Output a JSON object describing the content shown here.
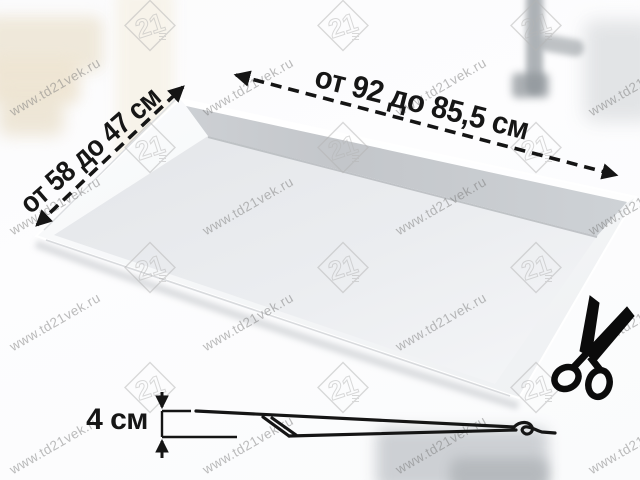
{
  "annotations": {
    "width_label": "от 92 до 85,5 см",
    "depth_label": "от 58 до 47 см",
    "height_label": "4 см"
  },
  "watermark": {
    "text": "www.td21vek.ru",
    "logo_text": "21"
  },
  "icons": [
    "scissors-icon"
  ],
  "colors": {
    "annotation_ink": "#151515",
    "watermark_gray": "#7a7a7a",
    "tray_surface": "#e9ebee",
    "tray_wall": "#c6c9cd",
    "background": "#fcfcfd"
  }
}
